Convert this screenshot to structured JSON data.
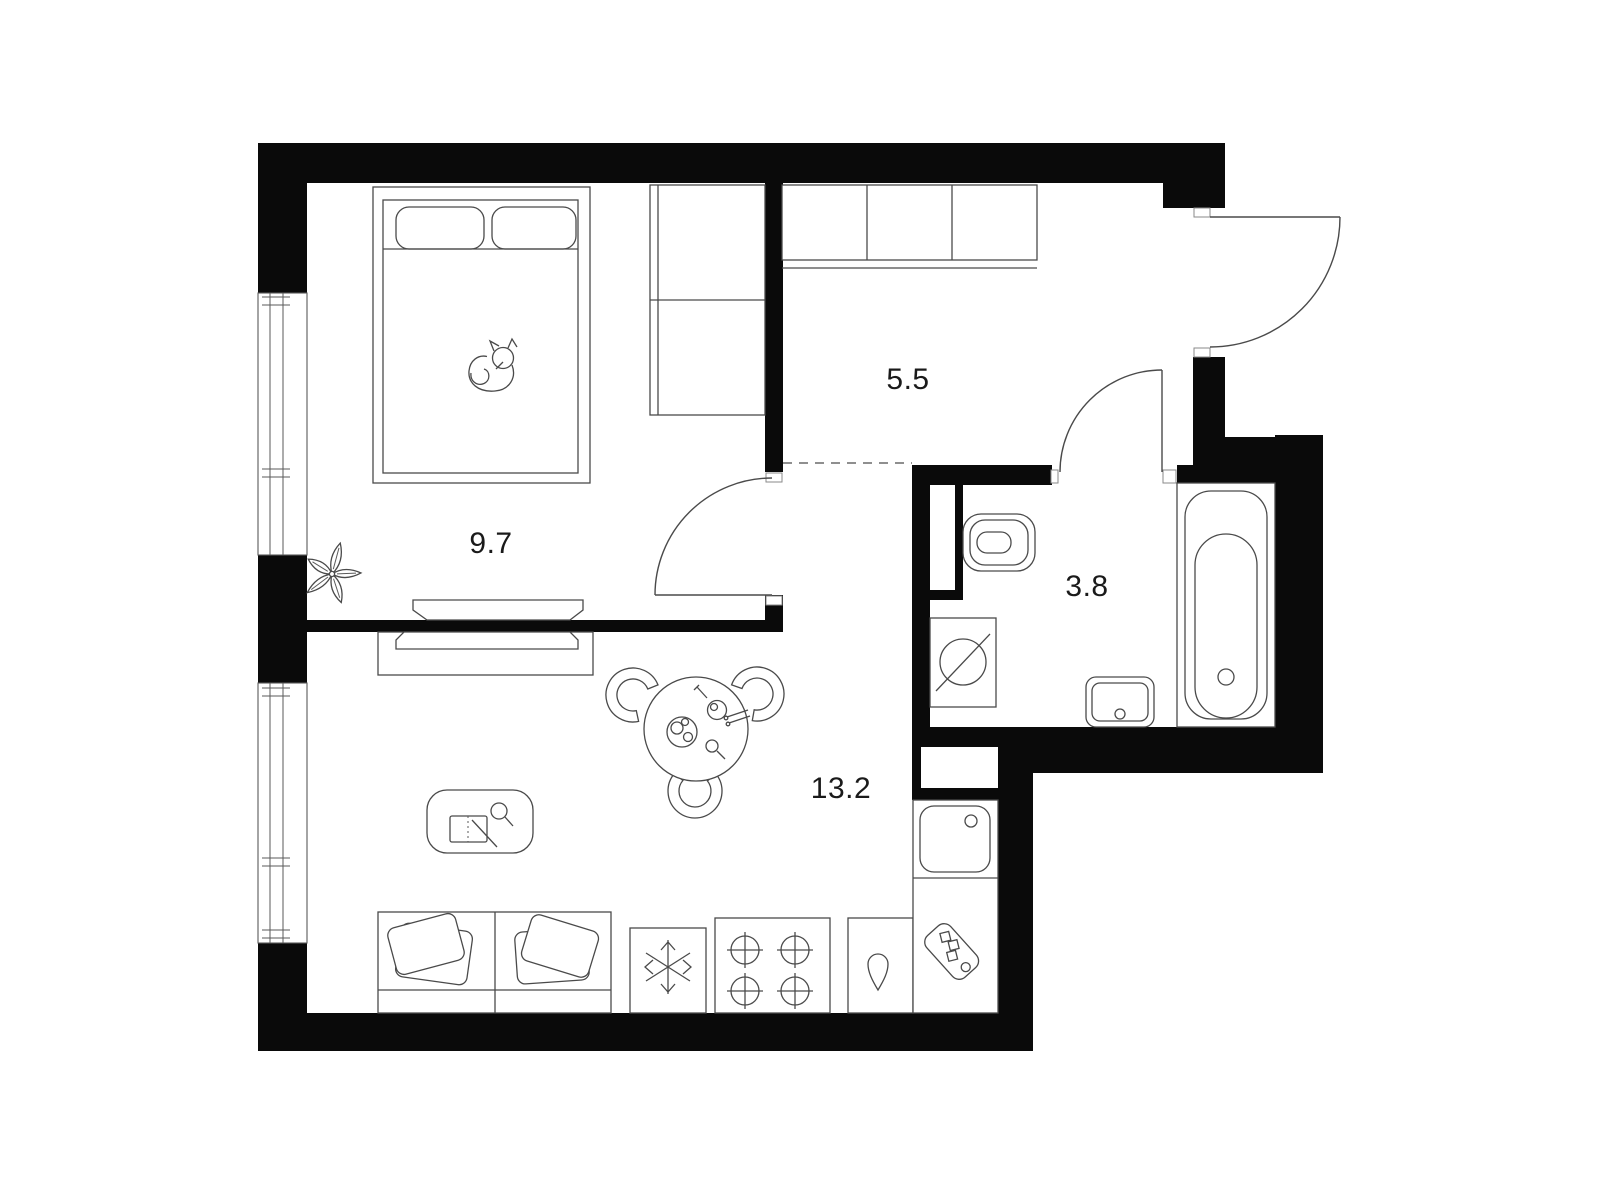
{
  "page": {
    "type": "apartment floor plan drawing",
    "background": "#ffffff"
  },
  "palette": {
    "wall": "#0a0a0a",
    "furniture_line": "#4a4a4a",
    "label_text": "#1a1a1a",
    "zone_boundary_dash": "#6a6a6a"
  },
  "rooms": {
    "bedroom": {
      "area_label": "9.7"
    },
    "hallway": {
      "area_label": "5.5"
    },
    "bathroom": {
      "area_label": "3.8"
    },
    "living_kitchen": {
      "area_label": "13.2"
    }
  },
  "icons": {
    "bed": "line-art",
    "cat": "line-art",
    "plant": "line-art",
    "wardrobe": "line-art",
    "hall-closet": "line-art",
    "tv": "line-art",
    "tv-cabinet": "line-art",
    "sofa": "line-art",
    "coffee-table": "line-art",
    "magnifier": "line-art",
    "dining-table": "line-art",
    "dining-chair": "line-art",
    "freezer-snowflake": "line-art",
    "stove-burners": "line-art",
    "kettle-drop": "line-art",
    "kitchen-sink": "line-art",
    "cutting-board": "line-art",
    "toilet": "line-art",
    "washing-machine": "line-art",
    "bathroom-sink": "line-art",
    "bathtub": "line-art",
    "window": "line-art",
    "door-swing": "line-art"
  }
}
